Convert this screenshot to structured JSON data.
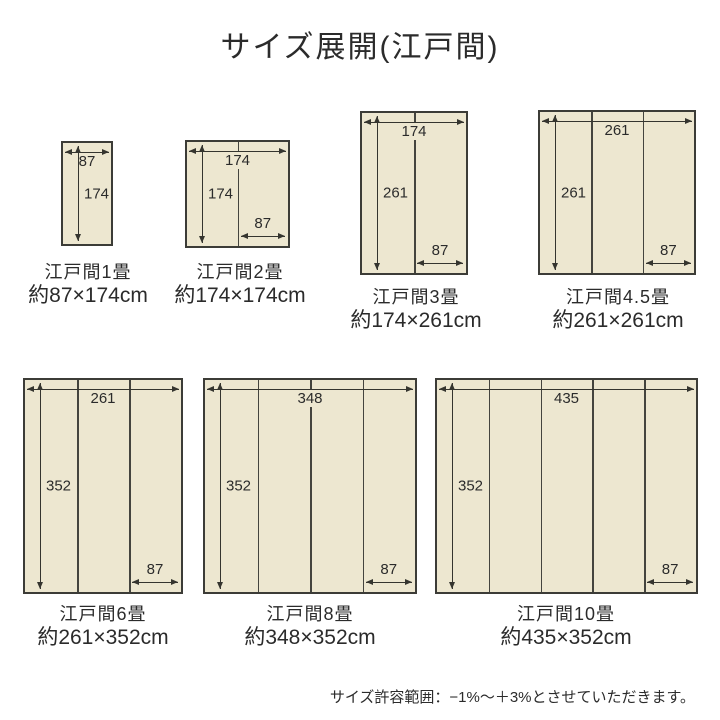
{
  "title": "サイズ展開(江戸間)",
  "note": "サイズ許容範囲：−1%〜＋3%とさせていただきます。",
  "unit": "cm",
  "colors": {
    "mat_fill": "#ede7d0",
    "mat_border": "#3c3c37",
    "arrow_line": "#35352f",
    "text": "#2b2b2b",
    "background": "#ffffff"
  },
  "diagrams": [
    {
      "name": "江戸間1畳",
      "size": "約87×174cm",
      "width_label": "87",
      "height_label": "174",
      "unit_label": "",
      "panels": 1
    },
    {
      "name": "江戸間2畳",
      "size": "約174×174cm",
      "width_label": "174",
      "height_label": "174",
      "unit_label": "87",
      "panels": 2
    },
    {
      "name": "江戸間3畳",
      "size": "約174×261cm",
      "width_label": "174",
      "height_label": "261",
      "unit_label": "87",
      "panels": 2
    },
    {
      "name": "江戸間4.5畳",
      "size": "約261×261cm",
      "width_label": "261",
      "height_label": "261",
      "unit_label": "87",
      "panels": 3
    },
    {
      "name": "江戸間6畳",
      "size": "約261×352cm",
      "width_label": "261",
      "height_label": "352",
      "unit_label": "87",
      "panels": 3
    },
    {
      "name": "江戸間8畳",
      "size": "約348×352cm",
      "width_label": "348",
      "height_label": "352",
      "unit_label": "87",
      "panels": 4
    },
    {
      "name": "江戸間10畳",
      "size": "約435×352cm",
      "width_label": "435",
      "height_label": "352",
      "unit_label": "87",
      "panels": 5
    }
  ]
}
